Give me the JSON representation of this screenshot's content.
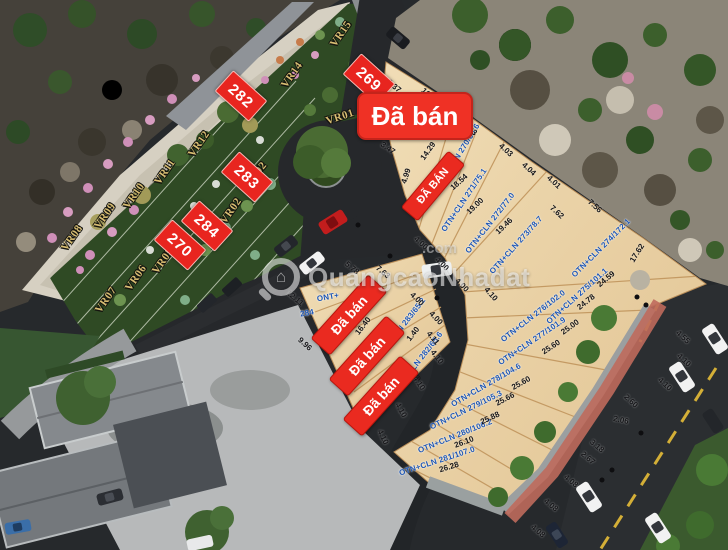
{
  "watermark": {
    "brand": "QuangcaoNhadat",
    "tld": ".com"
  },
  "badges": {
    "sold": [
      {
        "t": "Đã bán",
        "x": 415,
        "y": 116,
        "r": 0,
        "w": 112,
        "h": 44,
        "fs": 26,
        "big": true
      },
      {
        "t": "ĐÃ BÁN",
        "x": 433,
        "y": 186,
        "r": -50,
        "w": 72,
        "h": 20,
        "fs": 11
      },
      {
        "t": "Đã bán",
        "x": 349,
        "y": 315,
        "r": -48,
        "w": 84,
        "h": 24,
        "fs": 14
      },
      {
        "t": "Đã bán",
        "x": 367,
        "y": 356,
        "r": -48,
        "w": 84,
        "h": 24,
        "fs": 14
      },
      {
        "t": "Đã bán",
        "x": 381,
        "y": 396,
        "r": -48,
        "w": 84,
        "h": 24,
        "fs": 14
      }
    ],
    "numbers": [
      {
        "t": "269",
        "x": 369,
        "y": 79,
        "r": 42
      },
      {
        "t": "282",
        "x": 241,
        "y": 96,
        "r": 42
      },
      {
        "t": "283",
        "x": 247,
        "y": 177,
        "r": 42
      },
      {
        "t": "284",
        "x": 207,
        "y": 226,
        "r": 42
      },
      {
        "t": "270",
        "x": 180,
        "y": 245,
        "r": 42
      }
    ]
  },
  "garden_plots": [
    {
      "t": "VR01",
      "x": 340,
      "y": 117,
      "r": -18
    },
    {
      "t": "VR02",
      "x": 231,
      "y": 211,
      "r": -55
    },
    {
      "t": "02",
      "x": 261,
      "y": 168,
      "r": -50
    },
    {
      "t": "VR05",
      "x": 163,
      "y": 261,
      "r": -55
    },
    {
      "t": "VR06",
      "x": 136,
      "y": 278,
      "r": -55
    },
    {
      "t": "VR07",
      "x": 106,
      "y": 300,
      "r": -55
    },
    {
      "t": "VR08",
      "x": 72,
      "y": 238,
      "r": -55
    },
    {
      "t": "VR09",
      "x": 105,
      "y": 216,
      "r": -55
    },
    {
      "t": "VR10",
      "x": 134,
      "y": 196,
      "r": -55
    },
    {
      "t": "VR11",
      "x": 165,
      "y": 172,
      "r": -55
    },
    {
      "t": "VR12",
      "x": 199,
      "y": 144,
      "r": -55
    },
    {
      "t": "VR14",
      "x": 292,
      "y": 75,
      "r": -55
    },
    {
      "t": "VR15",
      "x": 341,
      "y": 34,
      "r": -55
    }
  ],
  "land_plots": [
    {
      "t": "OTN+CLN 270/65.6",
      "x": 458,
      "y": 156,
      "r": -58
    },
    {
      "t": "OTN+CLN 271/75.1",
      "x": 464,
      "y": 200,
      "r": -56
    },
    {
      "t": "OTN+CLN 272/77.0",
      "x": 490,
      "y": 223,
      "r": -52
    },
    {
      "t": "OTN+CLN 273/78.7",
      "x": 516,
      "y": 245,
      "r": -48
    },
    {
      "t": "OTN+CLN 274/172.1",
      "x": 601,
      "y": 248,
      "r": -45
    },
    {
      "t": "OTN+CLN 275/101.1",
      "x": 577,
      "y": 296,
      "r": -42
    },
    {
      "t": "OTN+CLN 276/102.0",
      "x": 533,
      "y": 316,
      "r": -38
    },
    {
      "t": "OTN+CLN 277/101.9",
      "x": 532,
      "y": 341,
      "r": -34
    },
    {
      "t": "OTN+CLN 278/104.6",
      "x": 486,
      "y": 385,
      "r": -30
    },
    {
      "t": "OTN+CLN 279/105.3",
      "x": 466,
      "y": 410,
      "r": -26
    },
    {
      "t": "OTN+CLN 280/106.2",
      "x": 455,
      "y": 436,
      "r": -22
    },
    {
      "t": "OTN+CLN 281/107.0",
      "x": 437,
      "y": 461,
      "r": -18
    },
    {
      "t": "OTN+CLN 283/65.2",
      "x": 401,
      "y": 328,
      "r": -52
    },
    {
      "t": "OTN+CLN 282/65.6",
      "x": 418,
      "y": 362,
      "r": -52
    },
    {
      "t": "ONT+",
      "x": 328,
      "y": 297,
      "r": -10
    },
    {
      "t": "284",
      "x": 307,
      "y": 313,
      "r": -10
    }
  ],
  "dimensions": [
    {
      "t": "8.37",
      "x": 394,
      "y": 86,
      "r": 40
    },
    {
      "t": "10.24",
      "x": 430,
      "y": 96,
      "r": 42
    },
    {
      "t": "5.14",
      "x": 372,
      "y": 112,
      "r": -72
    },
    {
      "t": "3.47",
      "x": 388,
      "y": 148,
      "r": 35
    },
    {
      "t": "14.29",
      "x": 428,
      "y": 151,
      "r": -55
    },
    {
      "t": "4.99",
      "x": 406,
      "y": 176,
      "r": -72
    },
    {
      "t": "18.54",
      "x": 459,
      "y": 182,
      "r": -42
    },
    {
      "t": "19.00",
      "x": 475,
      "y": 206,
      "r": -44
    },
    {
      "t": "19.46",
      "x": 504,
      "y": 226,
      "r": -44
    },
    {
      "t": "4.03",
      "x": 470,
      "y": 129,
      "r": 40
    },
    {
      "t": "4.03",
      "x": 506,
      "y": 150,
      "r": 42
    },
    {
      "t": "4.04",
      "x": 529,
      "y": 169,
      "r": 42
    },
    {
      "t": "4.01",
      "x": 554,
      "y": 182,
      "r": 42
    },
    {
      "t": "7.56",
      "x": 595,
      "y": 206,
      "r": 42
    },
    {
      "t": "7.62",
      "x": 557,
      "y": 212,
      "r": 42
    },
    {
      "t": "17.62",
      "x": 637,
      "y": 253,
      "r": -58
    },
    {
      "t": "24.59",
      "x": 606,
      "y": 279,
      "r": -40
    },
    {
      "t": "24.78",
      "x": 586,
      "y": 302,
      "r": -38
    },
    {
      "t": "25.00",
      "x": 570,
      "y": 327,
      "r": -36
    },
    {
      "t": "25.60",
      "x": 551,
      "y": 347,
      "r": -33
    },
    {
      "t": "25.60",
      "x": 521,
      "y": 383,
      "r": -29
    },
    {
      "t": "25.66",
      "x": 505,
      "y": 399,
      "r": -28
    },
    {
      "t": "25.88",
      "x": 490,
      "y": 418,
      "r": -25
    },
    {
      "t": "26.10",
      "x": 464,
      "y": 442,
      "r": -21
    },
    {
      "t": "26.28",
      "x": 449,
      "y": 467,
      "r": -17
    },
    {
      "t": "4.00",
      "x": 421,
      "y": 243,
      "r": 42
    },
    {
      "t": "4.00",
      "x": 442,
      "y": 264,
      "r": 44
    },
    {
      "t": "4.00",
      "x": 462,
      "y": 285,
      "r": 46
    },
    {
      "t": "4.00",
      "x": 417,
      "y": 299,
      "r": 44
    },
    {
      "t": "4.00",
      "x": 436,
      "y": 318,
      "r": 46
    },
    {
      "t": "1.40",
      "x": 413,
      "y": 334,
      "r": -52
    },
    {
      "t": "4.11",
      "x": 433,
      "y": 338,
      "r": 50
    },
    {
      "t": "4.10",
      "x": 437,
      "y": 357,
      "r": 52
    },
    {
      "t": "4.10",
      "x": 419,
      "y": 383,
      "r": 56
    },
    {
      "t": "4.10",
      "x": 401,
      "y": 410,
      "r": 60
    },
    {
      "t": "4.10",
      "x": 383,
      "y": 437,
      "r": 63
    },
    {
      "t": "4.10",
      "x": 491,
      "y": 294,
      "r": 48
    },
    {
      "t": "12.11",
      "x": 295,
      "y": 298,
      "r": 40
    },
    {
      "t": "9.96",
      "x": 305,
      "y": 344,
      "r": 42
    },
    {
      "t": "5.78",
      "x": 352,
      "y": 268,
      "r": 40
    },
    {
      "t": "7.63",
      "x": 383,
      "y": 272,
      "r": 40
    },
    {
      "t": "16.40",
      "x": 363,
      "y": 326,
      "r": -52
    },
    {
      "t": "2.60",
      "x": 631,
      "y": 401,
      "r": 42
    },
    {
      "t": "2.06",
      "x": 621,
      "y": 420,
      "r": 12
    },
    {
      "t": "3.18",
      "x": 597,
      "y": 446,
      "r": 40
    },
    {
      "t": "2.67",
      "x": 588,
      "y": 458,
      "r": 40
    },
    {
      "t": "4.08",
      "x": 571,
      "y": 481,
      "r": 40
    },
    {
      "t": "4.08",
      "x": 551,
      "y": 505,
      "r": 40
    },
    {
      "t": "4.08",
      "x": 538,
      "y": 531,
      "r": 40
    },
    {
      "t": "4.10",
      "x": 665,
      "y": 384,
      "r": 42
    },
    {
      "t": "4.10",
      "x": 684,
      "y": 360,
      "r": 42
    },
    {
      "t": "4.55",
      "x": 683,
      "y": 337,
      "r": 42
    }
  ]
}
